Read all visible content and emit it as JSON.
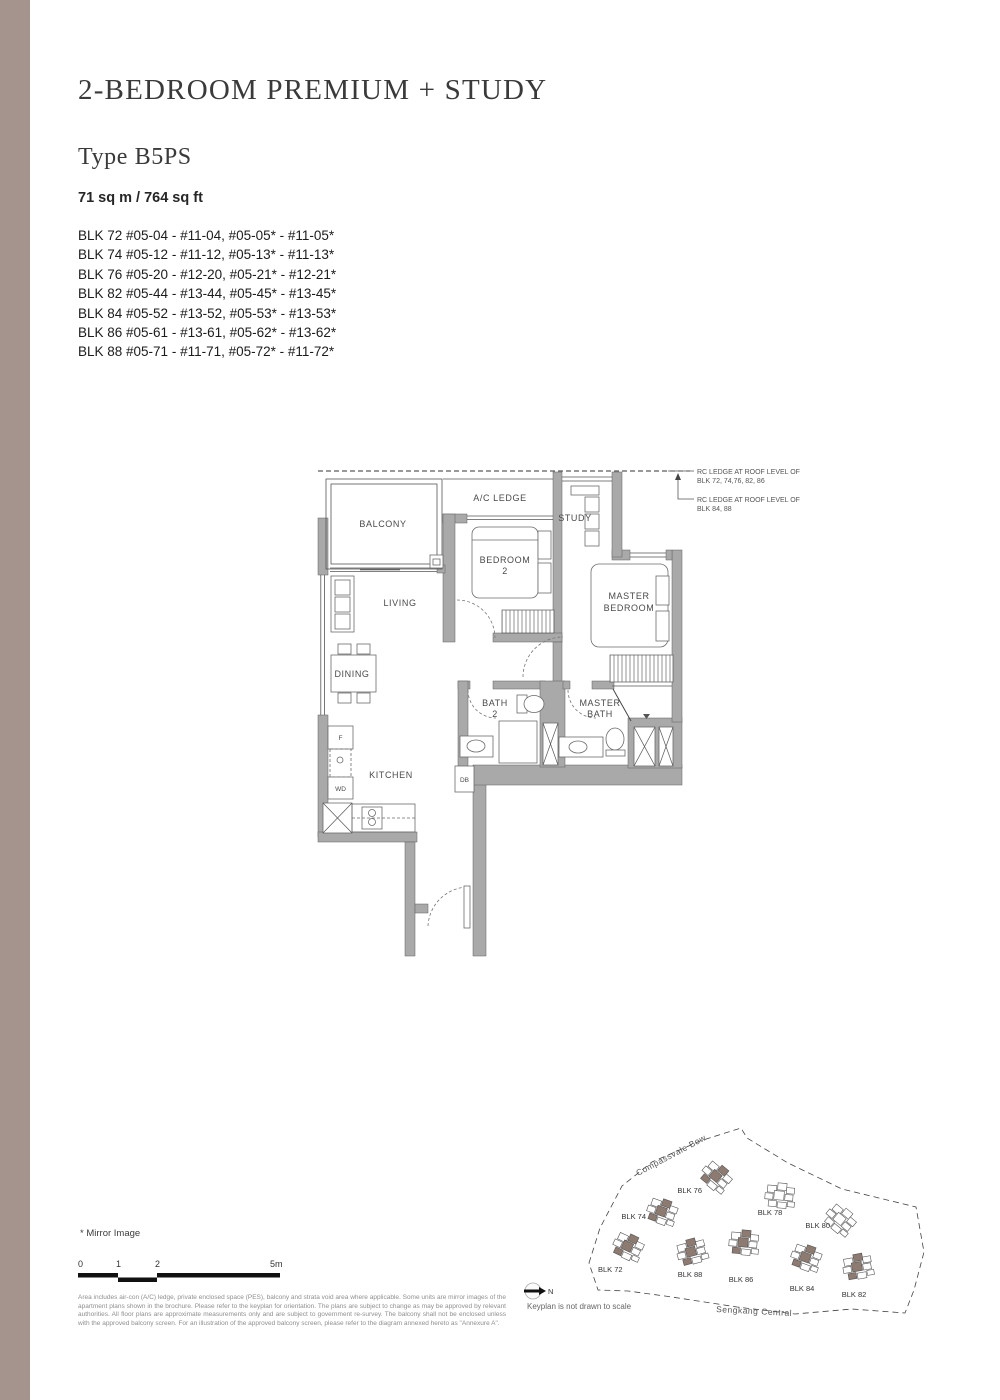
{
  "page": {
    "title": "2-BEDROOM PREMIUM + STUDY",
    "type_label": "Type B5PS",
    "area": "71 sq m / 764 sq ft"
  },
  "units": [
    "BLK 72 #05-04 - #11-04, #05-05* - #11-05*",
    "BLK 74 #05-12 - #11-12, #05-13* - #11-13*",
    "BLK 76 #05-20 - #12-20, #05-21* - #12-21*",
    "BLK 82 #05-44 - #13-44, #05-45* - #13-45*",
    "BLK 84 #05-52 - #13-52, #05-53* - #13-53*",
    "BLK 86 #05-61 - #13-61, #05-62* - #13-62*",
    "BLK 88 #05-71 - #11-71, #05-72* - #11-72*"
  ],
  "floorplan": {
    "labels": {
      "balcony": "BALCONY",
      "ac_ledge": "A/C LEDGE",
      "study": "STUDY",
      "bedroom2_l1": "BEDROOM",
      "bedroom2_l2": "2",
      "master_l1": "MASTER",
      "master_l2": "BEDROOM",
      "living": "LIVING",
      "dining": "DINING",
      "kitchen": "KITCHEN",
      "bath2_l1": "BATH",
      "bath2_l2": "2",
      "mbath_l1": "MASTER",
      "mbath_l2": "BATH",
      "db": "DB",
      "fridge": "F",
      "wd": "WD"
    },
    "notes": {
      "rc1_l1": "RC LEDGE AT ROOF LEVEL OF",
      "rc1_l2": "BLK 72, 74,76, 82, 86",
      "rc2_l1": "RC LEDGE AT ROOF LEVEL OF",
      "rc2_l2": "BLK 84, 88"
    }
  },
  "keyplan": {
    "roads": {
      "top": "Compassvale Bow",
      "bottom": "Sengkang Central"
    },
    "north_label": "N",
    "note": "Keyplan is not drawn to scale",
    "blocks": [
      {
        "label": "BLK 76",
        "highlighted": true
      },
      {
        "label": "BLK 74",
        "highlighted": true
      },
      {
        "label": "BLK 78",
        "highlighted": false
      },
      {
        "label": "BLK 80",
        "highlighted": false
      },
      {
        "label": "BLK 72",
        "highlighted": true
      },
      {
        "label": "BLK 88",
        "highlighted": true
      },
      {
        "label": "BLK 86",
        "highlighted": true
      },
      {
        "label": "BLK 84",
        "highlighted": true
      },
      {
        "label": "BLK 82",
        "highlighted": true
      }
    ]
  },
  "footer": {
    "mirror_note": "* Mirror Image",
    "scale_ticks": [
      "0",
      "1",
      "2",
      "5m"
    ],
    "disclaimer": "Area includes air-con (A/C) ledge, private enclosed space (PES), balcony and strata void area where applicable. Some units are mirror images of the apartment plans shown in the brochure. Please refer to the keyplan for orientation. The plans are subject to change as may be approved by relevant authorities. All floor plans are approximate measurements only and are subject to government re-survey. The balcony shall not be enclosed unless with the approved balcony screen. For an illustration of the approved balcony screen, please refer to the diagram annexed hereto as \"Annexure A\"."
  },
  "colors": {
    "accent_strip": "#a5948e",
    "wall": "#a9a9a9",
    "keyplan_highlight": "#8d7a71"
  }
}
